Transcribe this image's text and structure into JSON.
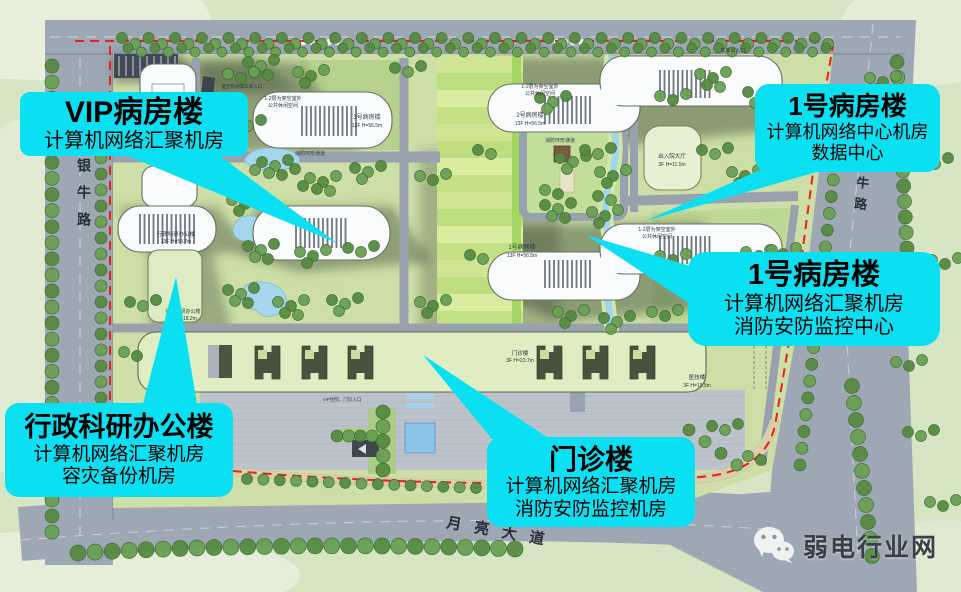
{
  "callouts": {
    "vip": {
      "title": "VIP病房楼",
      "line1": "计算机网络汇聚机房"
    },
    "ward1_top": {
      "title": "1号病房楼",
      "line1": "计算机网络中心机房",
      "line2": "数据中心"
    },
    "ward1_mid": {
      "title": "1号病房楼",
      "line1": "计算机网络汇聚机房",
      "line2": "消防安防监控中心"
    },
    "admin": {
      "title": "行政科研办公楼",
      "line1": "计算机网络汇聚机房",
      "line2": "容灾备份机房"
    },
    "outpatient": {
      "title": "门诊楼",
      "line1": "计算机网络汇聚机房",
      "line2": "消防安防监控机房"
    }
  },
  "roads": {
    "left": "银牛路",
    "right": "金牛路",
    "bottom": "月亮大道"
  },
  "watermark": {
    "brand": "弱电行业网"
  },
  "plan_labels": [
    {
      "x": 283,
      "y": 100,
      "t": "1-2层为架空室外",
      "s": 5
    },
    {
      "x": 283,
      "y": 107,
      "t": "公共休闲空间",
      "s": 5
    },
    {
      "x": 540,
      "y": 88,
      "t": "1-2层为架空室外",
      "s": 5
    },
    {
      "x": 540,
      "y": 95,
      "t": "公共休闲空间",
      "s": 5
    },
    {
      "x": 657,
      "y": 231,
      "t": "1-2层为架空室外",
      "s": 5
    },
    {
      "x": 657,
      "y": 238,
      "t": "公共休闲空间",
      "s": 5
    },
    {
      "x": 367,
      "y": 119,
      "t": "3号病房楼",
      "s": 6
    },
    {
      "x": 367,
      "y": 127,
      "t": "12F H=56.5m",
      "s": 5
    },
    {
      "x": 530,
      "y": 117,
      "t": "2号病房楼",
      "s": 6
    },
    {
      "x": 530,
      "y": 125,
      "t": "13F H=56.5m",
      "s": 5
    },
    {
      "x": 522,
      "y": 249,
      "t": "1号病房楼",
      "s": 6
    },
    {
      "x": 522,
      "y": 257,
      "t": "13F H=56.5m",
      "s": 5
    },
    {
      "x": 176,
      "y": 236,
      "t": "行政科研办公楼",
      "s": 5.5
    },
    {
      "x": 176,
      "y": 243,
      "t": "13F H=59.7m",
      "s": 5
    },
    {
      "x": 183,
      "y": 313,
      "t": "行政科研办公楼",
      "s": 5
    },
    {
      "x": 183,
      "y": 320,
      "t": "4F H=18.2m",
      "s": 5
    },
    {
      "x": 672,
      "y": 158,
      "t": "出入院大厅",
      "s": 5.5
    },
    {
      "x": 672,
      "y": 166,
      "t": "3F H=11.5m",
      "s": 5
    },
    {
      "x": 520,
      "y": 355,
      "t": "门诊楼",
      "s": 5.5
    },
    {
      "x": 520,
      "y": 362,
      "t": "3F H=23.7m",
      "s": 5
    },
    {
      "x": 697,
      "y": 379,
      "t": "医技楼",
      "s": 5.5
    },
    {
      "x": 697,
      "y": 387,
      "t": "3F H=19.5m",
      "s": 5
    },
    {
      "x": 310,
      "y": 155,
      "t": "消防环形通道",
      "s": 5
    },
    {
      "x": 560,
      "y": 142,
      "t": "消防环形通道",
      "s": 5
    },
    {
      "x": 733,
      "y": 52,
      "t": "车库出入口",
      "s": 5
    },
    {
      "x": 242,
      "y": 88,
      "t": "医疗街地库车库入口",
      "s": 4.5
    },
    {
      "x": 342,
      "y": 401,
      "t": "VIP住院、门诊入口",
      "s": 4.5
    },
    {
      "x": 103,
      "y": 420,
      "t": "用地红线",
      "s": 4.5,
      "rot": 90
    }
  ],
  "colors": {
    "callout_bg": "#0ae0f2",
    "callout_text": "#000000",
    "boundary_red": "#e82020",
    "road_gray": "#9ea8b4",
    "site_green": "#cddfa6",
    "water_blue": "#a6d6ee",
    "watermark_gray": "#393f46"
  }
}
